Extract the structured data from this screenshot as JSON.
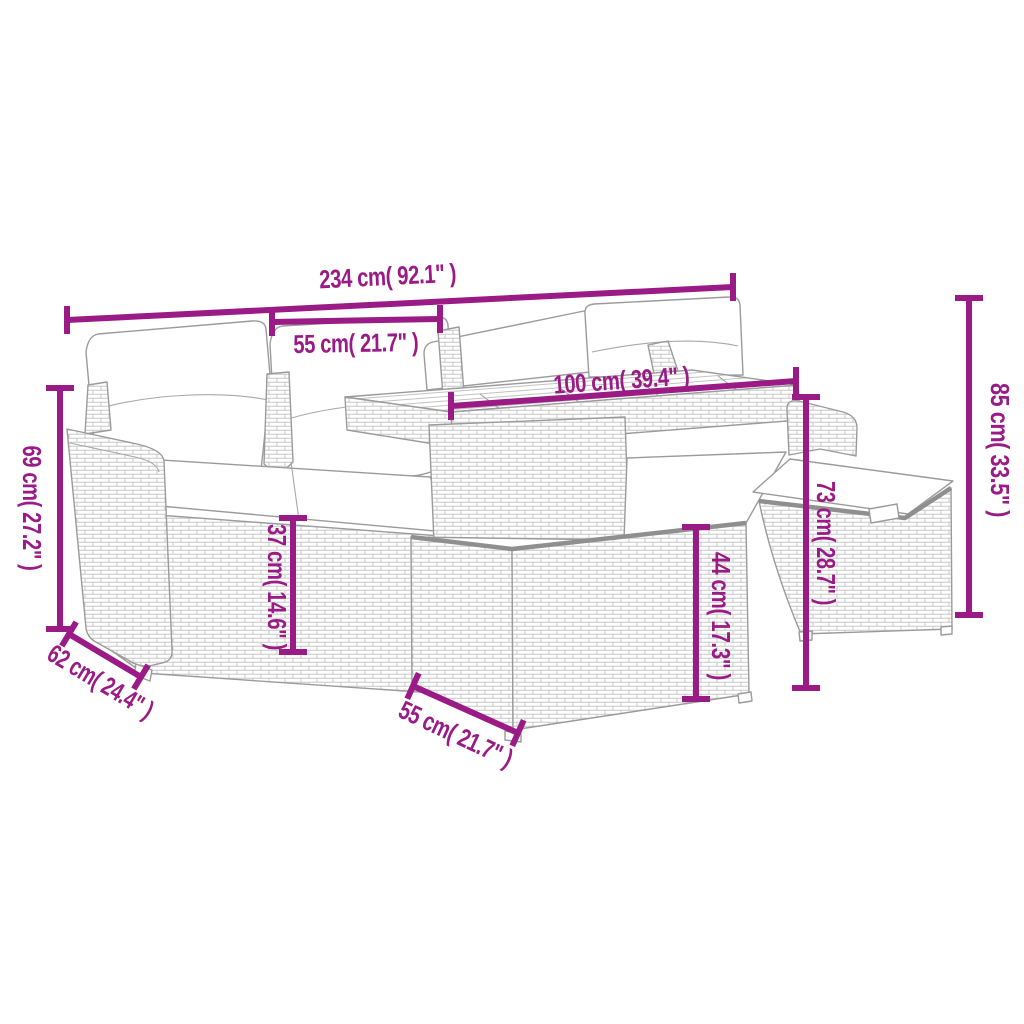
{
  "diagram": {
    "subject": "6 piece poly rattan garden lounge set with cushions, table and footstools — dimension drawing",
    "accent_color": "#9A1A86",
    "sketch_line_color": "#9B9B9B",
    "dimensions": {
      "overall_width": "234 cm( 92.1\" )",
      "seat_width": "55 cm( 21.7\" )",
      "tabletop_width": "100 cm( 39.4\" )",
      "overall_height": "85 cm( 33.5\" )",
      "armrest_height": "69 cm( 27.2\" )",
      "seat_depth": "62 cm( 24.4\" )",
      "seat_height": "37 cm( 14.6\" )",
      "footstool_height": "44 cm( 17.3\" )",
      "table_height": "73 cm( 28.7\" )",
      "footstool_width": "55 cm( 21.7\" )"
    }
  }
}
